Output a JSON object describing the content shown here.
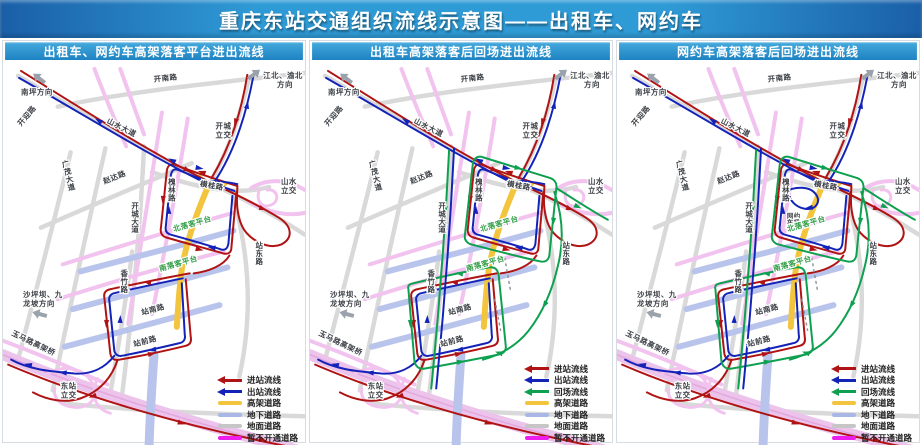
{
  "header": {
    "title": "重庆东站交通组织流线示意图——出租车、网约车"
  },
  "panels": [
    {
      "title": "出租车、网约车高架落客平台进出流线"
    },
    {
      "title": "出租车高架落客后回场进出流线"
    },
    {
      "title": "网约车高架落客后回场进出流线"
    }
  ],
  "legend_labels": {
    "enter": "进站流线",
    "exit": "出站流线",
    "return": "回场流线",
    "elevated": "高架道路",
    "underground": "地下道路",
    "ground": "地面道路",
    "closed": "暂不开通道路"
  },
  "map_labels": {
    "nanping": "南坪方向",
    "jiangbei_l1": "江北、渝北",
    "jiangbei_l2": "方向",
    "kainan": "开南路",
    "shanshui_ave": "山水大道",
    "kaicheng_ic_l1": "开城",
    "kaicheng_ic_l2": "立交",
    "kaiying": "开迎路",
    "guangmao": "广茂大道",
    "zhaoda": "赵达路",
    "kaicheng_ave": "开城大道",
    "huailin": "槐林路",
    "henggui": "横桂路",
    "shanshui_ic_l1": "山水",
    "shanshui_ic_l2": "立交",
    "north_platform": "北落客平台",
    "south_platform": "南落客平台",
    "zhandong": "站东路",
    "xiangzhu": "香竹路",
    "zhannan": "站南路",
    "zhanqian": "站前路",
    "shapingba_l1": "沙坪坝、九",
    "shapingba_l2": "龙坡方向",
    "yuma": "玉马路高架桥",
    "dongzhan_ic_l1": "东站",
    "dongzhan_ic_l2": "立交",
    "wangyueche_l1": "网约",
    "wangyueche_l2": "车场"
  },
  "colors": {
    "flow_enter": "#b01313",
    "flow_exit": "#1323b8",
    "flow_return": "#0ea04f",
    "road_elevated": "#f3c53e",
    "road_underground": "#b9c4ec",
    "road_ground": "#d9d9d9",
    "road_closed": "#ed1eed",
    "road_closed_map": "#f1c3ee",
    "freeway": "#ecc3ea",
    "platform_text": "#2f9e44",
    "header_edge": "#1a5fa8",
    "header_mid": "#2f9bd6",
    "titlebar_top": "#45aadc",
    "titlebar_bottom": "#1d82c2",
    "label_ink": "#3c4046",
    "dir_arrow": "#9aa2ab",
    "dash": "#8a8f98",
    "legend_underground": "#a9b6e6",
    "legend_ground": "#c6c6c6"
  }
}
